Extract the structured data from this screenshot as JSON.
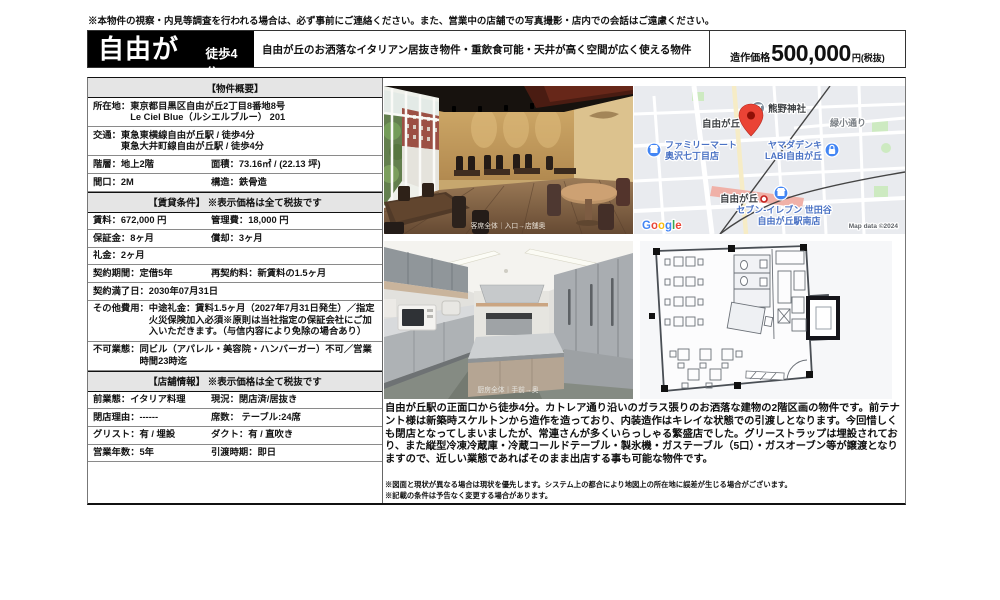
{
  "colors": {
    "brand_black": "#000000",
    "pin_red": "#EA4335",
    "poi_blue": "#4285F4",
    "map_bg": "#e9ebef",
    "section_bar_bg": "#e5e5e5"
  },
  "disclaimer": "※本物件の視察・内見等調査を行われる場合は、必ず事前にご連絡ください。また、営業中の店舗での写真撮影・店内での会話はご遠慮ください。",
  "header": {
    "station": "自由が丘",
    "walk": "徒歩4分",
    "catch": "自由が丘のお洒落なイタリアン居抜き物件・重飲食可能・天井が高く空間が広く使える物件",
    "price_label": "造作価格",
    "price_value": "500,000",
    "price_suffix": "円(税抜)"
  },
  "overview": {
    "title": "【物件概要】",
    "address_label": "所在地：",
    "address_line1": "東京都目黒区自由が丘2丁目8番地8号",
    "address_line2": "Le Ciel Blue（ルシエルブルー） 201",
    "access_label": "交通：",
    "access_line1": "東急東横線自由が丘駅 / 徒歩4分",
    "access_line2": "東急大井町線自由が丘駅 / 徒歩4分",
    "floor": "階層：地上2階",
    "area": "面積：73.16㎡ / (22.13 坪)",
    "frontage": "間口：2M",
    "structure": "構造：鉄骨造"
  },
  "lease": {
    "title": "【賃貸条件】 ※表示価格は全て税抜です",
    "rent": "賃料：672,000 円",
    "management_fee": "管理費：18,000 円",
    "deposit": "保証金：8ヶ月",
    "amortization": "償却：3ヶ月",
    "key_money": "礼金：2ヶ月",
    "contract_term": "契約期間：定借5年",
    "renewal_fee": "再契約料：新賃料の1.5ヶ月",
    "contract_end": "契約満了日：2030年07月31日",
    "other_label": "その他費用：",
    "other_value": "中途礼金：賃料1.5ヶ月（2027年7月31日発生）／指定火災保険加入必須※原則は当社指定の保証会社にご加入いただきます。（与信内容により免除の場合あり）",
    "prohibited_label": "不可業態：",
    "prohibited_value": "同ビル（アパレル・美容院・ハンバーガー）不可／営業時間23時迄"
  },
  "shop": {
    "title": "【店舗情報】 ※表示価格は全て税抜です",
    "previous_business": "前業態：イタリア料理",
    "current_state": "現況：閉店済/居抜き",
    "closing_reason": "閉店理由：------",
    "seats": "席数： テーブル:24席",
    "grease_trap": "グリスト：有 / 埋設",
    "duct": "ダクト：有 / 直吹き",
    "years": "営業年数：5年",
    "handover": "引渡時期：即日"
  },
  "photos": {
    "dining_caption": "客席全体｜入口→店舗奥",
    "kitchen_caption": "厨房全体｜手前→奥"
  },
  "map": {
    "area_top": "自由が丘",
    "shrine": "熊野神社",
    "street": "緑小通り",
    "familymart_1": "ファミリーマート",
    "familymart_2": "奥沢七丁目店",
    "yamada_1": "ヤマダデンキ",
    "yamada_2": "LABI自由が丘",
    "station": "自由が丘",
    "seveneleven_1": "セブン-イレブン 世田谷",
    "seveneleven_2": "自由が丘駅南店",
    "google_letters": [
      "G",
      "o",
      "o",
      "g",
      "l",
      "e"
    ],
    "copyright": "Map data ©2024"
  },
  "description": "自由が丘駅の正面口から徒歩4分。カトレア通り沿いのガラス張りのお洒落な建物の2階区画の物件です。前テナント様は新築時スケルトンから造作を造っており、内装造作はキレイな状態での引渡しとなります。今回惜しくも閉店となってしまいましたが、常連さんが多くいらっしゃる繁盛店でした。グリーストラップは埋設されており、また縦型冷凍冷蔵庫・冷蔵コールドテーブル・製氷機・ガステーブル（5口）・ガスオーブン等が譲渡となりますので、近しい業態であればそのまま出店する事も可能な物件です。",
  "footnotes": [
    "※図面と現状が異なる場合は現状を優先します。システム上の都合により地図上の所在地に誤差が生じる場合がございます。",
    "※記載の条件は予告なく変更する場合があります。"
  ]
}
